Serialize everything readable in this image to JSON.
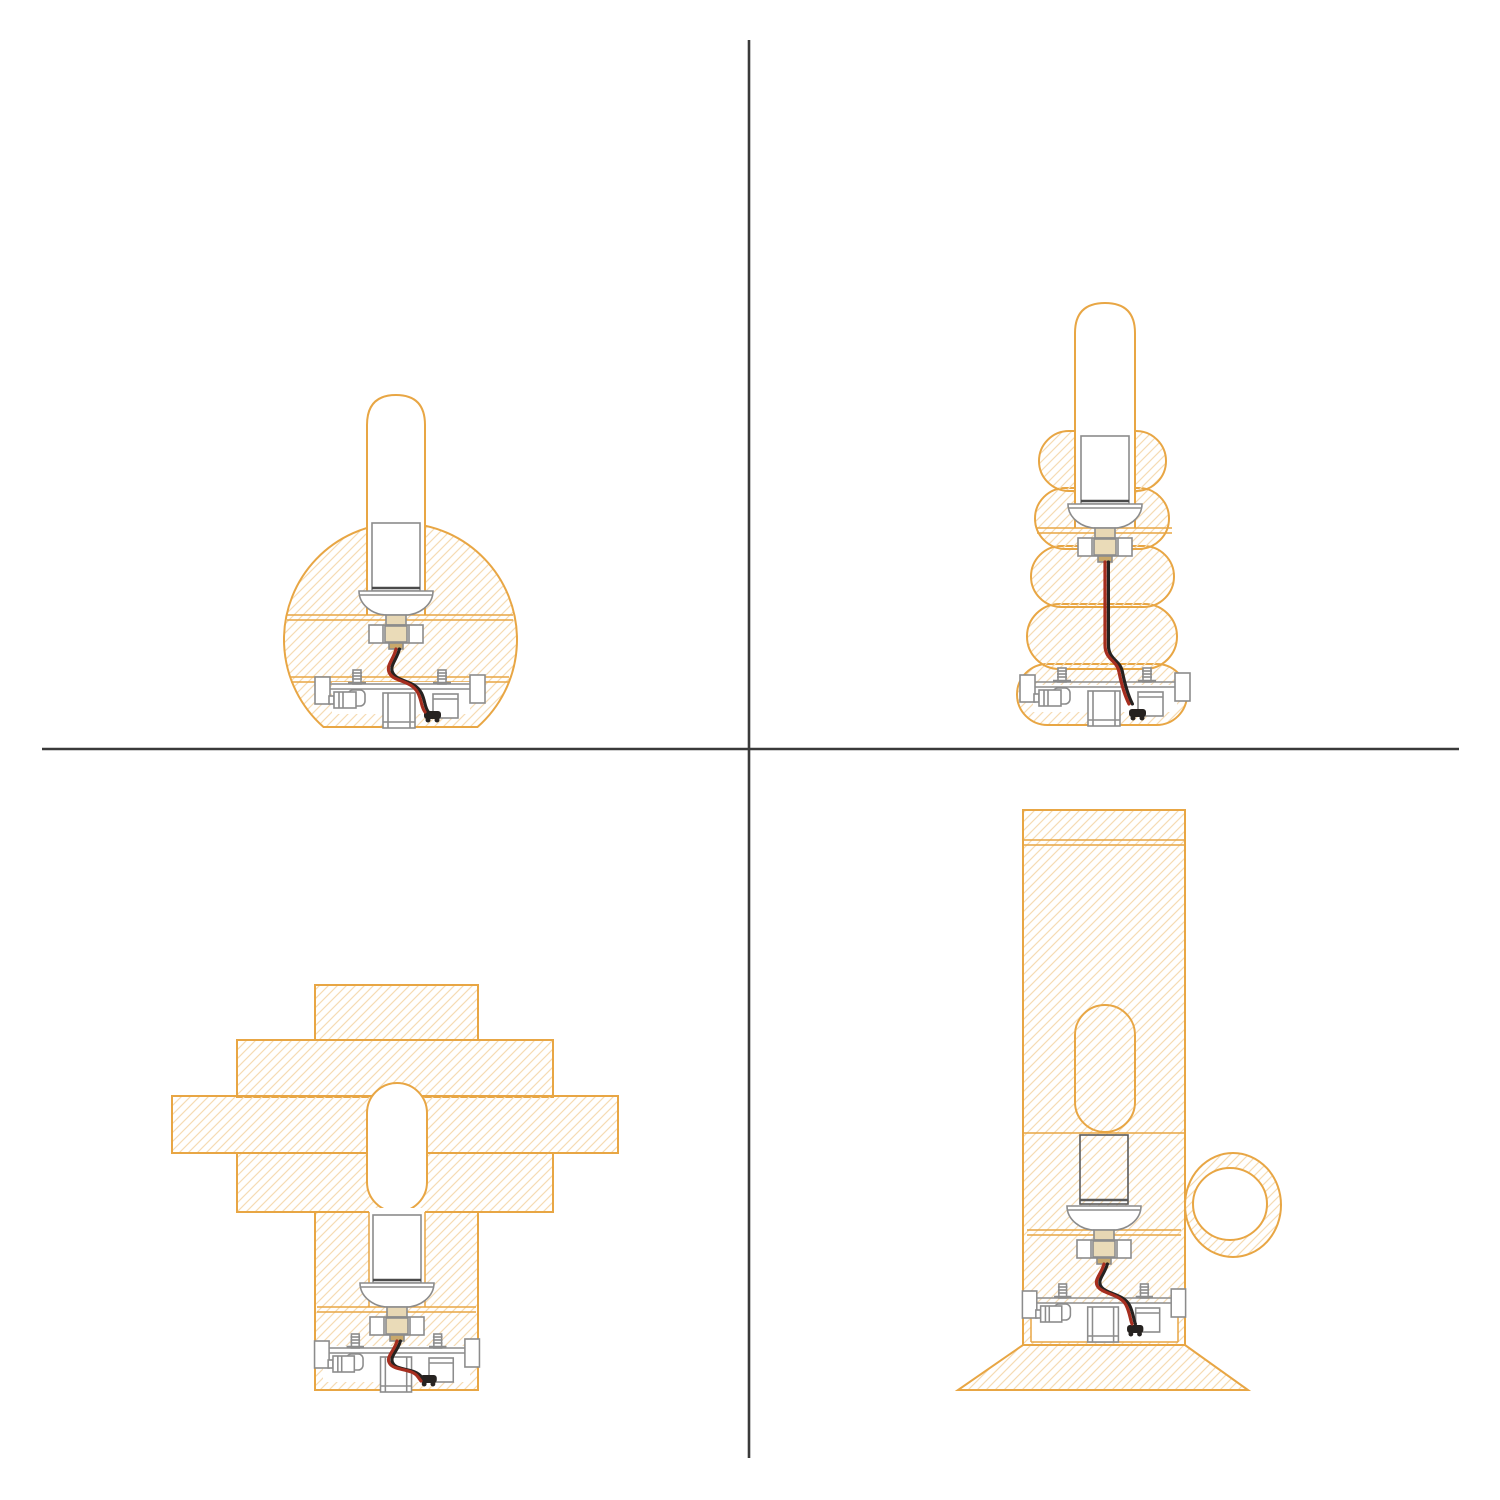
{
  "canvas": {
    "width": 1500,
    "height": 1500,
    "background": "#FFFFFF"
  },
  "colors": {
    "outline_orange": "#E8A644",
    "hatch": "#F5DCB4",
    "metal_gray": "#8C8C8C",
    "metal_dark": "#4A4A4A",
    "wire_red": "#A62E1F",
    "wire_black": "#262220",
    "tan_fill": "#EADBB8",
    "divider": "#3A3A3A",
    "white": "#FFFFFF"
  },
  "dividers": {
    "vertical": {
      "x": 749,
      "y1": 40,
      "y2": 1458
    },
    "horizontal": {
      "y": 749,
      "x1": 42,
      "x2": 1459
    }
  },
  "panels": [
    {
      "id": "top-left",
      "label": "Sphere lamp cross-section with tubular bulb"
    },
    {
      "id": "top-right",
      "label": "Stacked bubbles lamp cross-section with tubular bulb"
    },
    {
      "id": "bottom-left",
      "label": "Stacked slabs lamp cross-section with tubular bulb"
    },
    {
      "id": "bottom-right",
      "label": "Cylinder lamp with ring handle and flared base cross-section"
    }
  ]
}
